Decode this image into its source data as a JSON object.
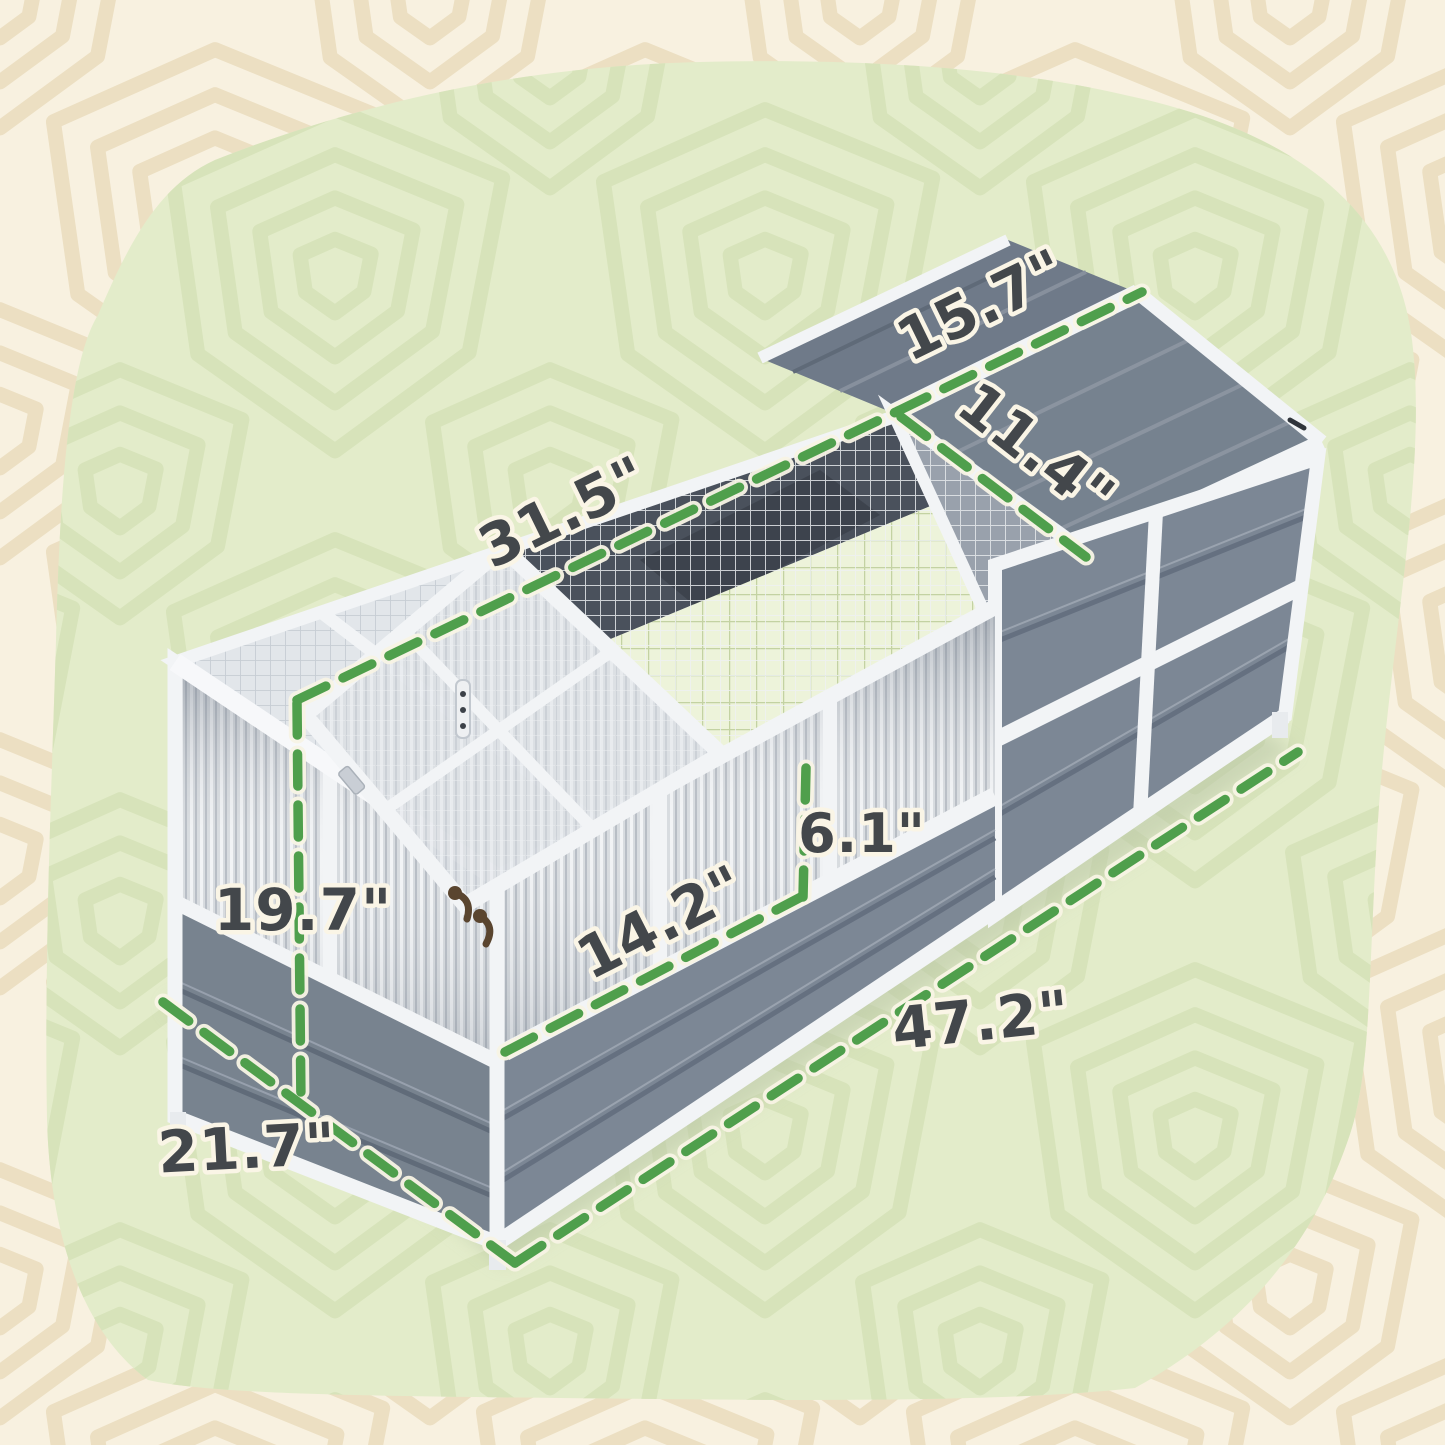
{
  "scene": {
    "description": "Product dimension diagram of a wooden cold-frame pet enclosure",
    "background": {
      "outer_color": "#f8f1e0",
      "outer_pattern_color": "#ecdfc2",
      "blob_color": "#e3ecca",
      "blob_pattern_color": "#d7e3ba"
    },
    "accent": {
      "dash_color": "#4f9f4c",
      "dash_halo": "#f8f4e5",
      "label_color": "#43474b",
      "label_halo": "#faf5e6"
    }
  },
  "product": {
    "kind": "grey and white wooden enclosure with mesh roof, corrugated panels and open lid",
    "palette": {
      "frame_white": "#f2f4f6",
      "panel_grey": "#7c8795",
      "roof_grey": "#73808e",
      "mesh_line": "#c3cad1",
      "mat_green": "#edf3da",
      "interior_dark": "#4a515c",
      "latch_bronze": "#5a452f"
    }
  },
  "dims": [
    {
      "id": "ridge-left",
      "text": "31.5\""
    },
    {
      "id": "ridge-right",
      "text": "15.7\""
    },
    {
      "id": "roof-slope",
      "text": "11.4\""
    },
    {
      "id": "panel-height",
      "text": "6.1\""
    },
    {
      "id": "lid-opening",
      "text": "14.2\""
    },
    {
      "id": "height",
      "text": "19.7\""
    },
    {
      "id": "length",
      "text": "47.2\""
    },
    {
      "id": "depth",
      "text": "21.7\""
    }
  ]
}
